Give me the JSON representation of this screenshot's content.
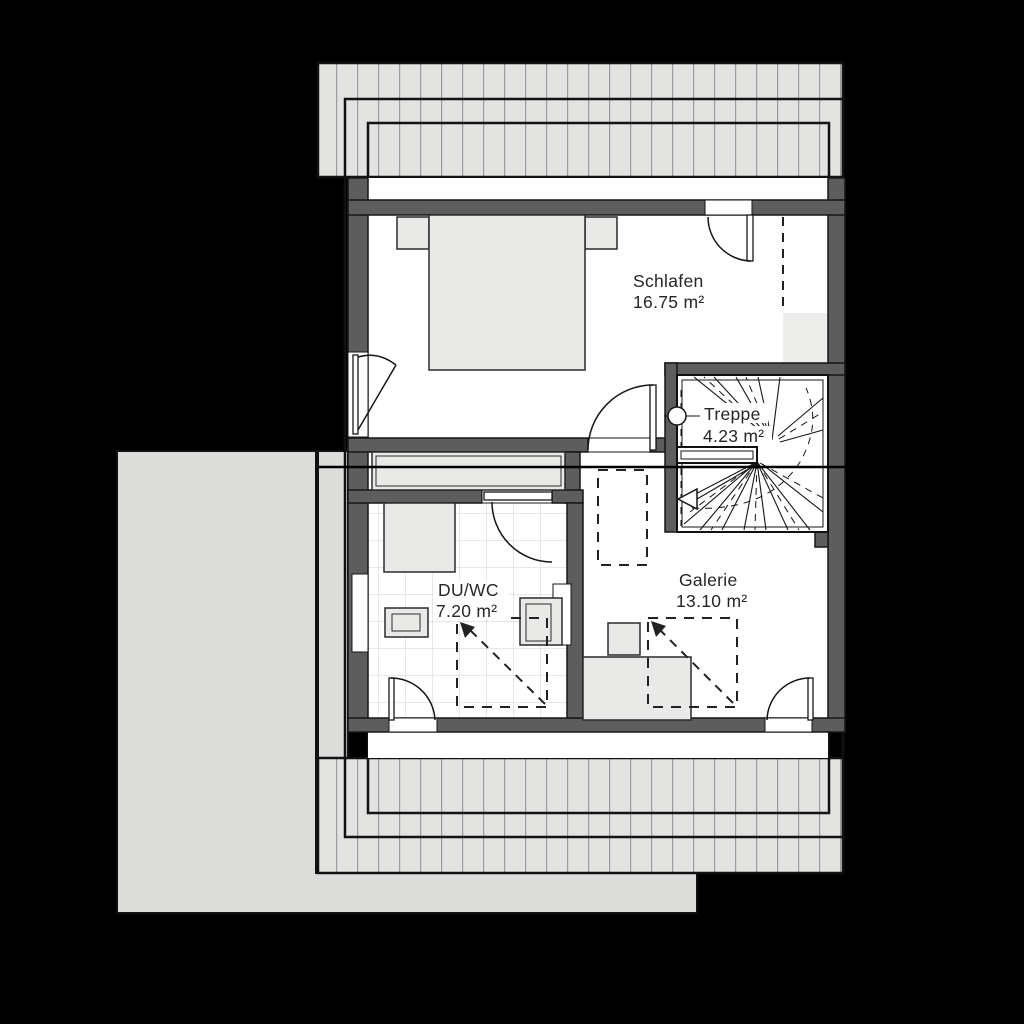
{
  "plan": {
    "type": "floor-plan",
    "rooms": [
      {
        "id": "schlafen",
        "name": "Schlafen",
        "area": "16.75 m²"
      },
      {
        "id": "treppe",
        "name": "Treppe",
        "area": "4.23 m²"
      },
      {
        "id": "duwc",
        "name": "DU/WC",
        "area": "7.20 m²"
      },
      {
        "id": "galerie",
        "name": "Galerie",
        "area": "13.10 m²"
      }
    ],
    "features": {
      "stair_direction_arrow": "left-down",
      "roof_overhang_hatch": "vertical-lines",
      "section_line": "horizontal"
    },
    "colors": {
      "background": "#000000",
      "wall": "#5d5d5d",
      "room_floor": "#ffffff",
      "furniture": "#e9e9e7",
      "roof_hatch": "#e3e3e1",
      "terrace_roof": "#dcdddb",
      "low_height_zone": "#ededeb",
      "line": "#161616",
      "label_text": "#262626"
    }
  }
}
